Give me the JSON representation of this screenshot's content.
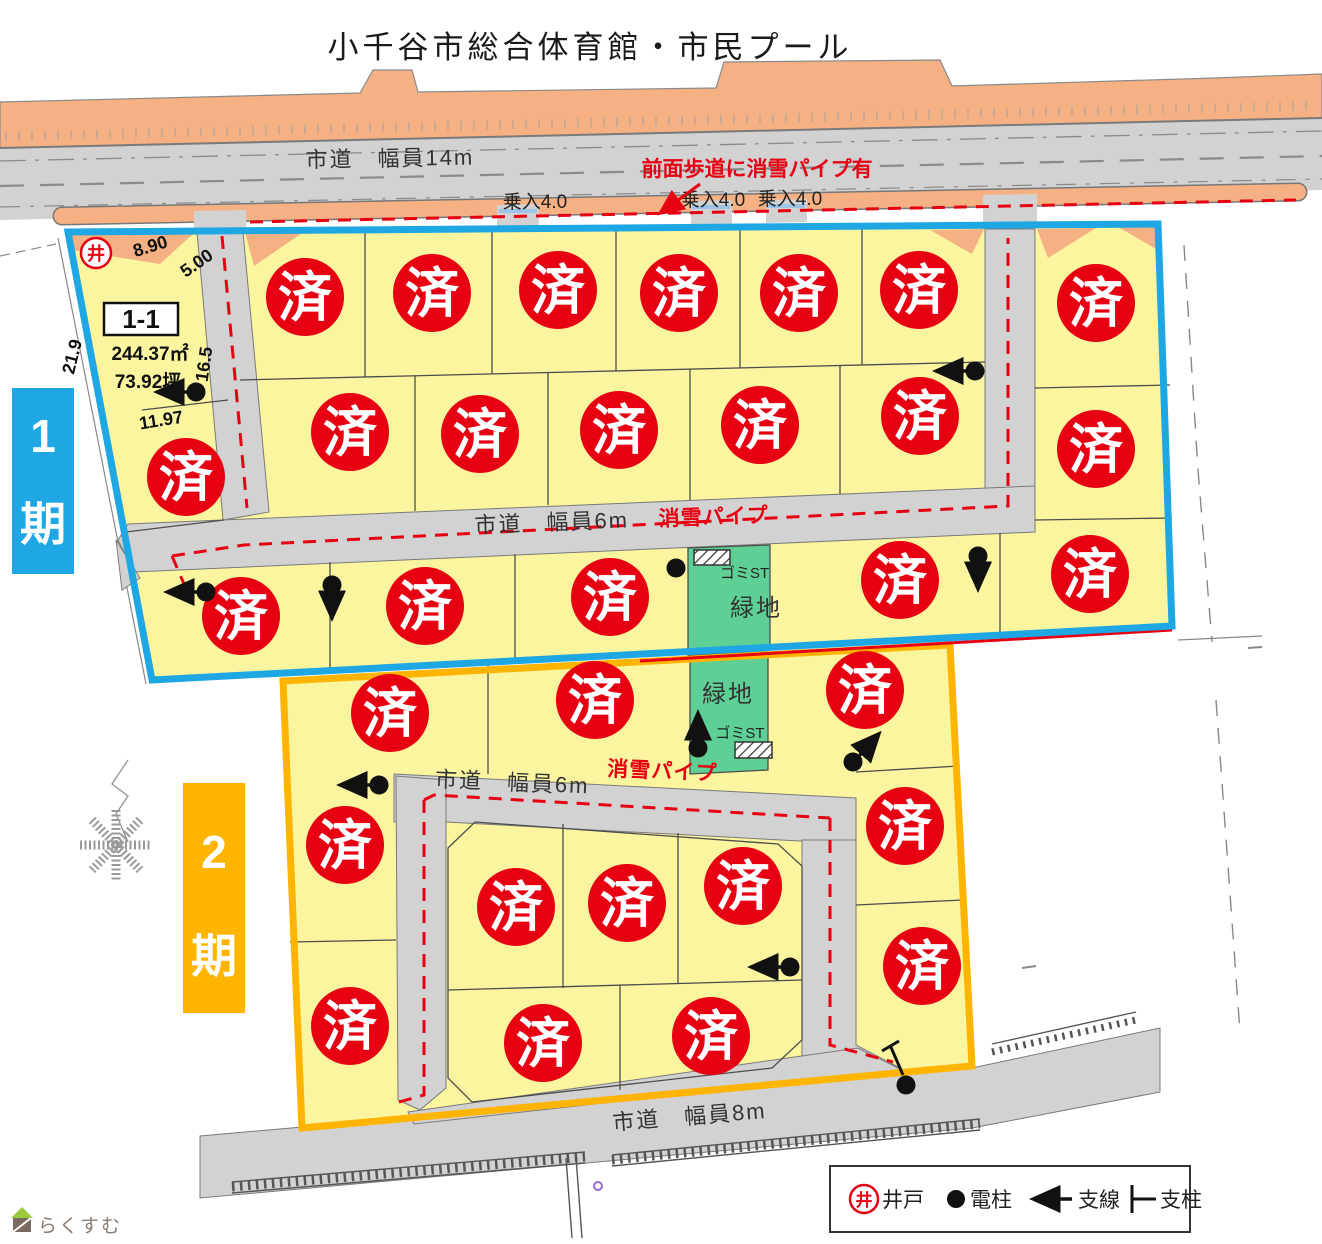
{
  "title": "小千谷市総合体育館・市民プール",
  "colors": {
    "phase1": "#1ea7e3",
    "phase2": "#ffb400",
    "sold": "#e60012",
    "lot_yellow": "#fbf5a0",
    "road_gray": "#d2d2d2",
    "sidewalk_orange": "#f5b183",
    "green": "#5fd095"
  },
  "roads": {
    "top_label": "市道　幅員14m",
    "ring1_label": "市道　幅員6m",
    "ring2_label": "市道　幅員6m",
    "bottom_label": "市道　幅員8m"
  },
  "notes": {
    "sidewalk_pipe": "前面歩道に消雪パイプ有",
    "pipe1": "消雪パイプ",
    "pipe2": "消雪パイプ",
    "entries": [
      "乗入4.0",
      "乗入4.0",
      "乗入4.0"
    ],
    "green1": "緑地",
    "green2": "緑地",
    "gomi1": "ゴミST",
    "gomi2": "ゴミST"
  },
  "phase1": {
    "num": "1",
    "kanji": "期"
  },
  "phase2": {
    "num": "2",
    "kanji": "期"
  },
  "available_lot": {
    "number": "1-1",
    "area_m2": "244.37㎡",
    "area_tsubo": "73.92坪",
    "dim_top1": "8.90",
    "dim_top2": "5.00",
    "dim_left": "21.9",
    "dim_road": "16.5",
    "dim_bottom": "11.97"
  },
  "well_symbol": "井",
  "sold_label": "済",
  "sold_marks": {
    "phase1": [
      [
        305,
        297
      ],
      [
        432,
        293
      ],
      [
        558,
        290
      ],
      [
        679,
        293
      ],
      [
        799,
        293
      ],
      [
        919,
        290
      ],
      [
        1096,
        303
      ],
      [
        350,
        432
      ],
      [
        480,
        434
      ],
      [
        619,
        430
      ],
      [
        760,
        425
      ],
      [
        920,
        416
      ],
      [
        1096,
        449
      ],
      [
        186,
        477
      ],
      [
        241,
        616
      ],
      [
        425,
        606
      ],
      [
        610,
        597
      ],
      [
        900,
        580
      ],
      [
        1090,
        574
      ]
    ],
    "phase2": [
      [
        390,
        713
      ],
      [
        595,
        700
      ],
      [
        865,
        690
      ],
      [
        345,
        845
      ],
      [
        350,
        1026
      ],
      [
        905,
        826
      ],
      [
        922,
        966
      ],
      [
        516,
        907
      ],
      [
        627,
        903
      ],
      [
        743,
        886
      ],
      [
        543,
        1043
      ],
      [
        711,
        1036
      ]
    ]
  },
  "poles": [
    {
      "x": 196,
      "y": 392,
      "dir": "left"
    },
    {
      "x": 975,
      "y": 371,
      "dir": "left"
    },
    {
      "x": 206,
      "y": 592,
      "dir": "left"
    },
    {
      "x": 332,
      "y": 585,
      "dir": "down"
    },
    {
      "x": 978,
      "y": 556,
      "dir": "down"
    },
    {
      "x": 676,
      "y": 568,
      "dir": "none"
    },
    {
      "x": 379,
      "y": 785,
      "dir": "left"
    },
    {
      "x": 698,
      "y": 748,
      "dir": "up"
    },
    {
      "x": 853,
      "y": 762,
      "dir": "ne"
    },
    {
      "x": 790,
      "y": 967,
      "dir": "left"
    },
    {
      "x": 906,
      "y": 1085,
      "dir": "none"
    }
  ],
  "legend": {
    "well_symbol": "井",
    "well": "井戸",
    "pole": "電柱",
    "guy": "支線",
    "post": "支柱"
  },
  "logo_text": "らくすむ"
}
